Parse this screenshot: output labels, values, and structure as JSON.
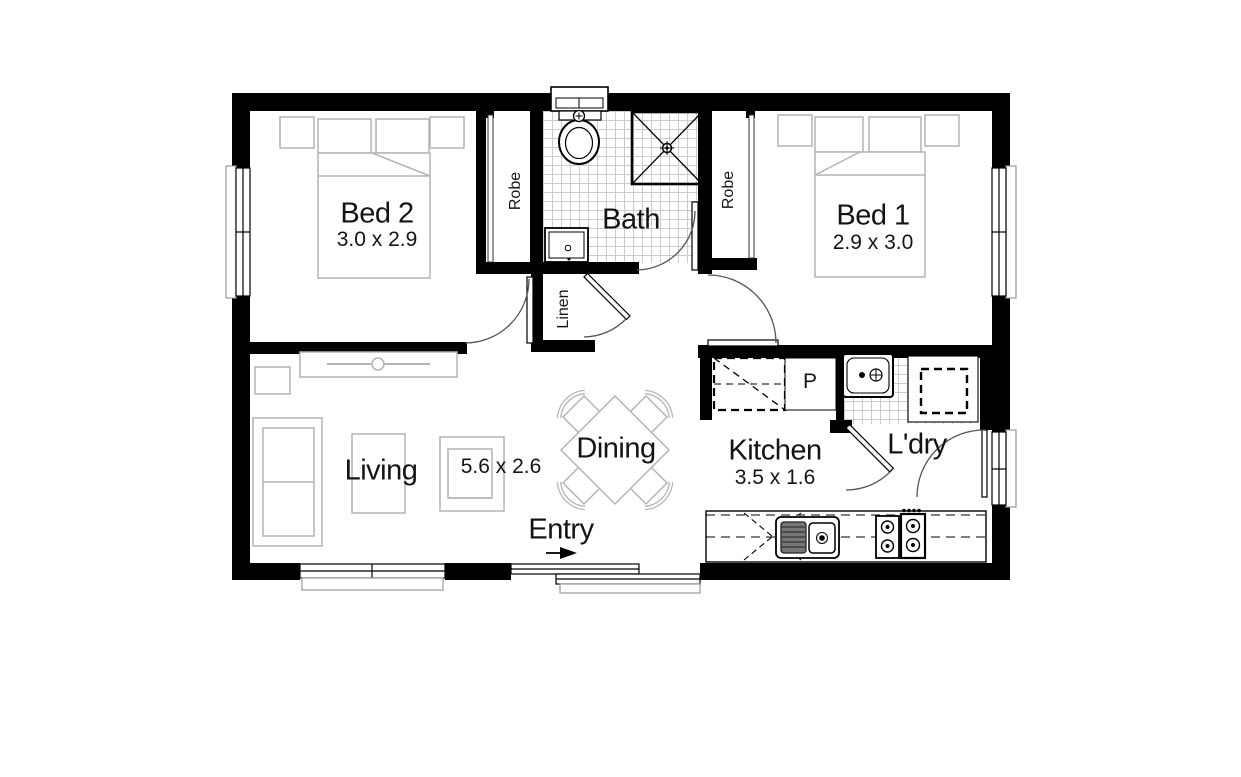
{
  "plan": {
    "rooms": {
      "bed2": {
        "name": "Bed 2",
        "dims": "3.0 x 2.9"
      },
      "bed1": {
        "name": "Bed 1",
        "dims": "2.9 x 3.0"
      },
      "bath": {
        "name": "Bath"
      },
      "living": {
        "name": "Living",
        "dims": "5.6 x 2.6"
      },
      "dining": {
        "name": "Dining"
      },
      "entry": {
        "name": "Entry"
      },
      "kitchen": {
        "name": "Kitchen",
        "dims": "3.5 x 1.6"
      },
      "laundry": {
        "name": "L'dry"
      }
    },
    "fixtures": {
      "robe_bed2": "Robe",
      "robe_bed1": "Robe",
      "linen": "Linen",
      "pantry": "P"
    },
    "colors": {
      "wall": "#000000",
      "furniture_outline": "#b4b4b4",
      "tile_line": "#cccccc",
      "text": "#141414"
    }
  }
}
